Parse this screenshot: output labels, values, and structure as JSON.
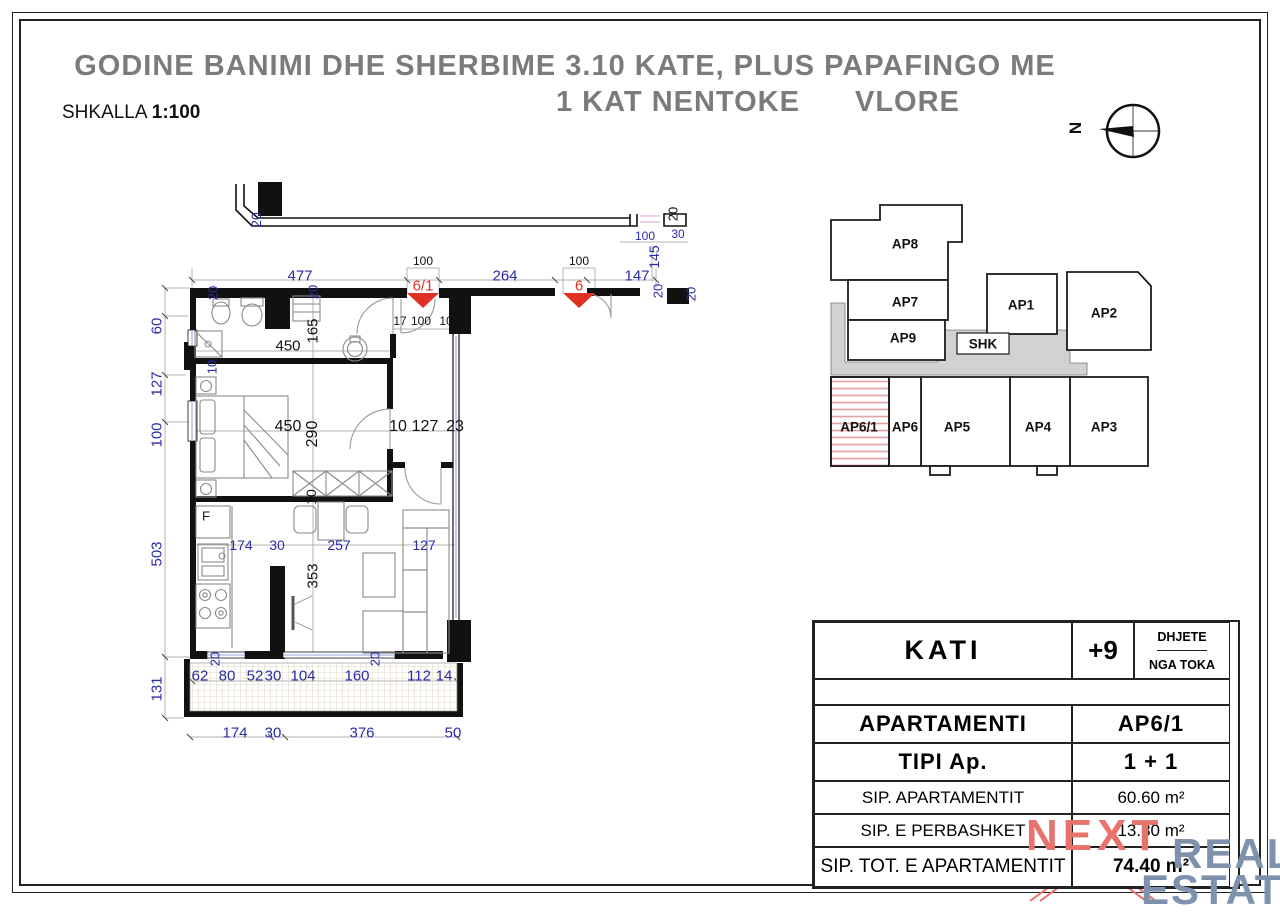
{
  "title": {
    "line1": "GODINE BANIMI DHE SHERBIME 3.10  KATE, PLUS PAPAFINGO ME",
    "line2_left": "1 KAT NENTOKE",
    "line2_right": "VLORE"
  },
  "scale": {
    "label": "SHKALLA",
    "value": "1:100"
  },
  "compass": {
    "label": "N"
  },
  "colors": {
    "dimension_blue": "#2b2ba8",
    "dimension_black": "#111111",
    "entrance_red": "#e03024",
    "title_gray": "#7b7b7b",
    "corridor_gray": "#d2d2d2",
    "hatch_red": "#e4a3a3",
    "logo_red": "#e8736c",
    "logo_blue": "#7e92ad"
  },
  "floorplan": {
    "kitchen_fridge_label": "F",
    "entrance_markers": [
      "6/1",
      "6"
    ],
    "dimensions": [
      {
        "t": "477",
        "x": 300,
        "y": 276,
        "c": "b",
        "s": 15
      },
      {
        "t": "100",
        "x": 423,
        "y": 261,
        "c": "k",
        "s": 12
      },
      {
        "t": "6/1",
        "x": 423,
        "y": 286,
        "c": "r",
        "s": 15
      },
      {
        "t": "264",
        "x": 505,
        "y": 276,
        "c": "b",
        "s": 15
      },
      {
        "t": "100",
        "x": 579,
        "y": 261,
        "c": "k",
        "s": 12
      },
      {
        "t": "6",
        "x": 579,
        "y": 286,
        "c": "r",
        "s": 15
      },
      {
        "t": "147",
        "x": 637,
        "y": 276,
        "c": "b",
        "s": 15
      },
      {
        "t": "20",
        "x": 256,
        "y": 220,
        "r": 1,
        "c": "b",
        "s": 14
      },
      {
        "t": "20",
        "x": 673,
        "y": 214,
        "r": 1,
        "c": "k",
        "s": 13
      },
      {
        "t": "100",
        "x": 645,
        "y": 236,
        "c": "b",
        "s": 12
      },
      {
        "t": "30",
        "x": 678,
        "y": 234,
        "c": "b",
        "s": 12
      },
      {
        "t": "145",
        "x": 654,
        "y": 257,
        "r": 1,
        "c": "b",
        "s": 14
      },
      {
        "t": "20",
        "x": 658,
        "y": 291,
        "r": 1,
        "c": "b",
        "s": 13
      },
      {
        "t": "20",
        "x": 691,
        "y": 294,
        "r": 1,
        "c": "b",
        "s": 13
      },
      {
        "t": "60",
        "x": 157,
        "y": 326,
        "r": 1,
        "c": "b",
        "s": 15
      },
      {
        "t": "127",
        "x": 157,
        "y": 384,
        "r": 1,
        "c": "b",
        "s": 15
      },
      {
        "t": "100",
        "x": 157,
        "y": 435,
        "r": 1,
        "c": "b",
        "s": 15
      },
      {
        "t": "503",
        "x": 157,
        "y": 554,
        "r": 1,
        "c": "b",
        "s": 15
      },
      {
        "t": "131",
        "x": 157,
        "y": 689,
        "r": 1,
        "c": "b",
        "s": 15
      },
      {
        "t": "20",
        "x": 213,
        "y": 293,
        "r": 1,
        "c": "b",
        "s": 13
      },
      {
        "t": "20",
        "x": 313,
        "y": 292,
        "r": 1,
        "c": "b",
        "s": 13
      },
      {
        "t": "165",
        "x": 313,
        "y": 331,
        "r": 1,
        "c": "k",
        "s": 15
      },
      {
        "t": "450",
        "x": 288,
        "y": 346,
        "c": "k",
        "s": 15
      },
      {
        "t": "10",
        "x": 212,
        "y": 367,
        "r": 1,
        "c": "b",
        "s": 13
      },
      {
        "t": "17",
        "x": 400,
        "y": 321,
        "c": "k",
        "s": 12
      },
      {
        "t": "100",
        "x": 421,
        "y": 321,
        "c": "k",
        "s": 12
      },
      {
        "t": "10",
        "x": 446,
        "y": 321,
        "c": "k",
        "s": 12
      },
      {
        "t": "450",
        "x": 288,
        "y": 427,
        "c": "k",
        "s": 16
      },
      {
        "t": "290",
        "x": 313,
        "y": 434,
        "r": 1,
        "c": "k",
        "s": 16
      },
      {
        "t": "10",
        "x": 398,
        "y": 427,
        "c": "k",
        "s": 16
      },
      {
        "t": "127",
        "x": 425,
        "y": 427,
        "c": "k",
        "s": 16
      },
      {
        "t": "23",
        "x": 455,
        "y": 427,
        "c": "k",
        "s": 16
      },
      {
        "t": "10",
        "x": 311,
        "y": 497,
        "r": 1,
        "c": "k",
        "s": 14
      },
      {
        "t": "174",
        "x": 241,
        "y": 545,
        "c": "b",
        "s": 14
      },
      {
        "t": "30",
        "x": 277,
        "y": 545,
        "c": "b",
        "s": 14
      },
      {
        "t": "257",
        "x": 339,
        "y": 545,
        "c": "b",
        "s": 14
      },
      {
        "t": "127",
        "x": 424,
        "y": 545,
        "c": "b",
        "s": 14
      },
      {
        "t": "353",
        "x": 313,
        "y": 576,
        "r": 1,
        "c": "k",
        "s": 15
      },
      {
        "t": "20",
        "x": 215,
        "y": 659,
        "r": 1,
        "c": "b",
        "s": 13
      },
      {
        "t": "20",
        "x": 375,
        "y": 659,
        "r": 1,
        "c": "b",
        "s": 13
      },
      {
        "t": "62",
        "x": 200,
        "y": 676,
        "c": "b",
        "s": 15
      },
      {
        "t": "80",
        "x": 227,
        "y": 676,
        "c": "b",
        "s": 15
      },
      {
        "t": "52",
        "x": 255,
        "y": 676,
        "c": "b",
        "s": 15
      },
      {
        "t": "30",
        "x": 273,
        "y": 676,
        "c": "b",
        "s": 15
      },
      {
        "t": "104",
        "x": 303,
        "y": 676,
        "c": "b",
        "s": 15
      },
      {
        "t": "160",
        "x": 357,
        "y": 676,
        "c": "b",
        "s": 15
      },
      {
        "t": "112",
        "x": 419,
        "y": 676,
        "c": "b",
        "s": 15
      },
      {
        "t": "14",
        "x": 444,
        "y": 676,
        "c": "b",
        "s": 15
      },
      {
        "t": "174",
        "x": 235,
        "y": 733,
        "c": "b",
        "s": 15
      },
      {
        "t": "30",
        "x": 273,
        "y": 733,
        "c": "b",
        "s": 15
      },
      {
        "t": "376",
        "x": 362,
        "y": 733,
        "c": "b",
        "s": 15
      },
      {
        "t": "50",
        "x": 453,
        "y": 733,
        "c": "b",
        "s": 15
      },
      {
        "t": "F",
        "x": 206,
        "y": 516,
        "c": "k",
        "s": 13
      }
    ]
  },
  "keyplan": {
    "highlight": "AP6/1",
    "units": [
      {
        "id": "AP8",
        "x": 905,
        "y": 244
      },
      {
        "id": "AP7",
        "x": 905,
        "y": 302
      },
      {
        "id": "AP9",
        "x": 903,
        "y": 338
      },
      {
        "id": "AP1",
        "x": 1021,
        "y": 305
      },
      {
        "id": "AP2",
        "x": 1104,
        "y": 313
      },
      {
        "id": "SHK",
        "x": 983,
        "y": 344
      },
      {
        "id": "AP6/1",
        "x": 859,
        "y": 427
      },
      {
        "id": "AP6",
        "x": 905,
        "y": 427
      },
      {
        "id": "AP5",
        "x": 957,
        "y": 427
      },
      {
        "id": "AP4",
        "x": 1038,
        "y": 427
      },
      {
        "id": "AP3",
        "x": 1104,
        "y": 427
      }
    ]
  },
  "table": {
    "kati_label": "KATI",
    "kati_value": "+9",
    "kati_note1": "DHJETE",
    "kati_note2": "NGA TOKA",
    "apartamenti_label": "APARTAMENTI",
    "apartamenti_value": "AP6/1",
    "tipi_label": "TIPI Ap.",
    "tipi_value": "1 + 1",
    "sip1_label": "SIP. APARTAMENTIT",
    "sip1_value": "60.60 m²",
    "sip2_label": "SIP. E PERBASHKET",
    "sip2_value": "13.80 m²",
    "sip3_label": "SIP. TOT. E APARTAMENTIT",
    "sip3_value": "74.40 m²"
  },
  "logo": {
    "next": "NEXT",
    "real": "REAL",
    "estate": "ESTATE"
  }
}
